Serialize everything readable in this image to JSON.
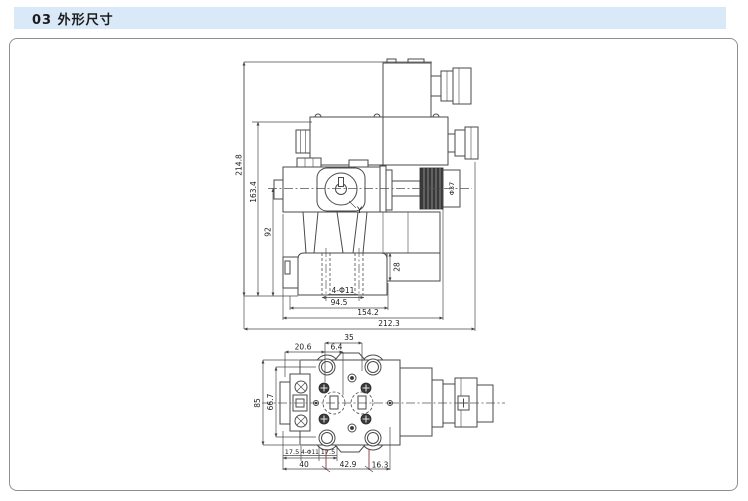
{
  "header": {
    "title": "03 外形尺寸"
  },
  "front_view": {
    "dims": {
      "overall_height": "214.8",
      "height_to_coil_top": "163.4",
      "height_to_centerline": "92",
      "subplate_height": "28",
      "mounting_holes": "4-Φ11",
      "bolt_span": "94.5",
      "body_width": "154.2",
      "overall_width": "212.3",
      "knob_diameter": "Φ37",
      "port_label": "Y"
    }
  },
  "top_view": {
    "dims": {
      "port_span": "35",
      "offset_left": "20.6",
      "offset_mid": "6.4",
      "plate_height": "85",
      "hole_span_vertical": "66.7",
      "pitch_left": "17.5",
      "mounting_holes": "4-Φ11",
      "pitch_right": "17.5",
      "base_width": "40",
      "hole_span_horizontal": "42.9",
      "edge_offset": "16.3"
    }
  }
}
